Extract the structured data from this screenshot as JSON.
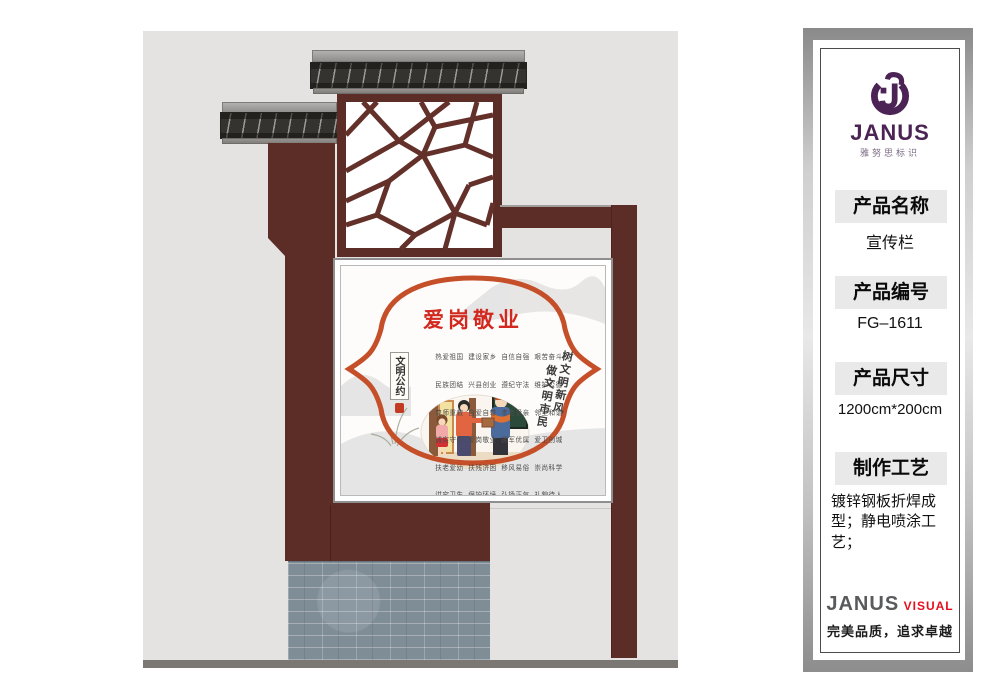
{
  "sidebar": {
    "logo": {
      "brand": "JANUS",
      "subtitle": "雅努思标识"
    },
    "sections": [
      {
        "label": "产品名称",
        "value": "宣传栏"
      },
      {
        "label": "产品编号",
        "value": "FG–1611"
      },
      {
        "label": "产品尺寸",
        "value": "1200cm*200cm"
      },
      {
        "label": "制作工艺",
        "value": "镀锌钢板折焊成型；静电喷涂工艺；"
      }
    ],
    "footer": {
      "brand": "JANUS",
      "brand2": "VISUAL",
      "tagline": "完美品质，追求卓越"
    }
  },
  "poster": {
    "title": "爱岗敬业",
    "rows": [
      "热爱祖国  建设家乡  自信自强  艰苦奋斗",
      "民族团结  兴县创业  遵纪守法  维护公德",
      "尊师重教  自爱自尊  孝老爱亲  邻里和谐",
      "诚实守信  爱岗敬业  拥军优属  爱卫创城",
      "扶老爱幼  扶残济困  移风易俗  崇尚科学",
      "讲究卫生  保护环境  弘扬正气  礼貌待人"
    ],
    "left_tag": "文明公约",
    "vertical_right_1": "树文明新风",
    "vertical_right_2": "做文明市民"
  },
  "colors": {
    "wood_red": "#5b2d26",
    "accent_red": "#c44f28",
    "brand_purple": "#4b2455",
    "visual_red": "#e60f1e"
  }
}
